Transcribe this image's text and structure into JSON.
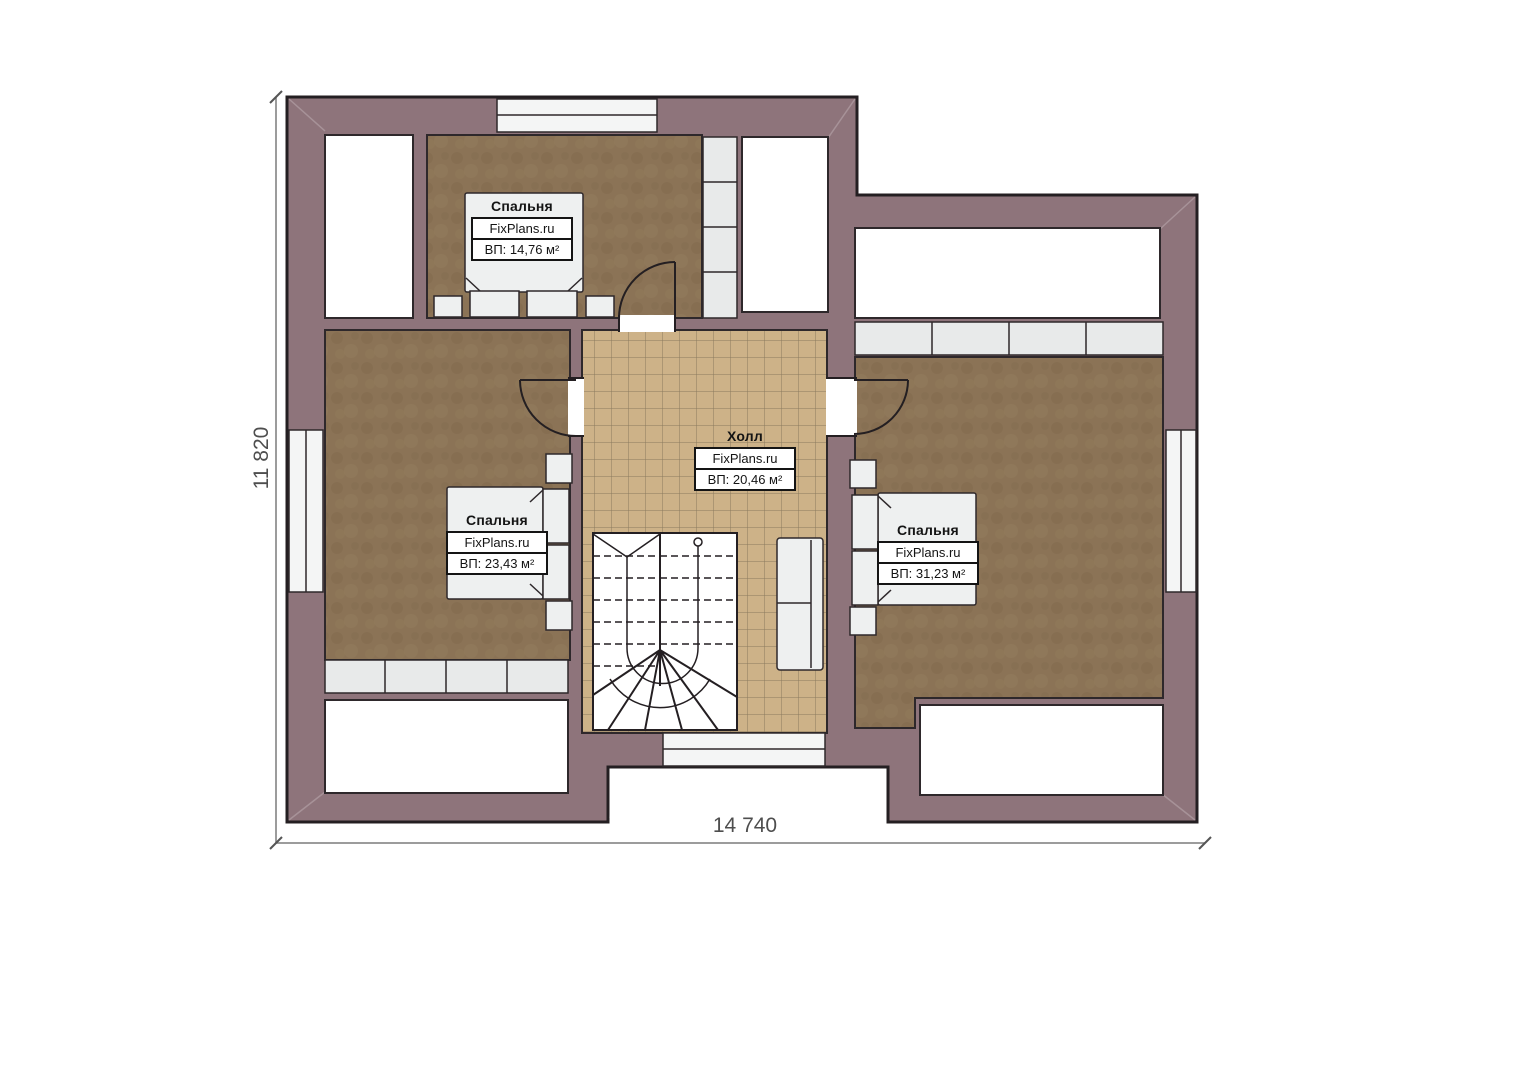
{
  "plan": {
    "brand": "FixPlans.ru",
    "rooms": [
      {
        "id": "bedroom-top",
        "name": "Спальня",
        "source": "FixPlans.ru",
        "area": "ВП: 14,76 м²"
      },
      {
        "id": "bedroom-left",
        "name": "Спальня",
        "source": "FixPlans.ru",
        "area": "ВП: 23,43 м²"
      },
      {
        "id": "hall",
        "name": "Холл",
        "source": "FixPlans.ru",
        "area": "ВП: 20,46 м²"
      },
      {
        "id": "bedroom-right",
        "name": "Спальня",
        "source": "FixPlans.ru",
        "area": "ВП: 31,23 м²"
      }
    ],
    "dimensions": {
      "overall_height": "11 820",
      "overall_width": "14 740"
    },
    "colors": {
      "wall": "#8e747b",
      "outline": "#241f22",
      "bedroom_floor": "#8b7356",
      "hall_tile": "#cdb288",
      "tile_line": "#8a7a5e",
      "closet": "#e8eaea",
      "furniture": "#eef0f0",
      "dimension_line": "#7b7b7b"
    }
  }
}
